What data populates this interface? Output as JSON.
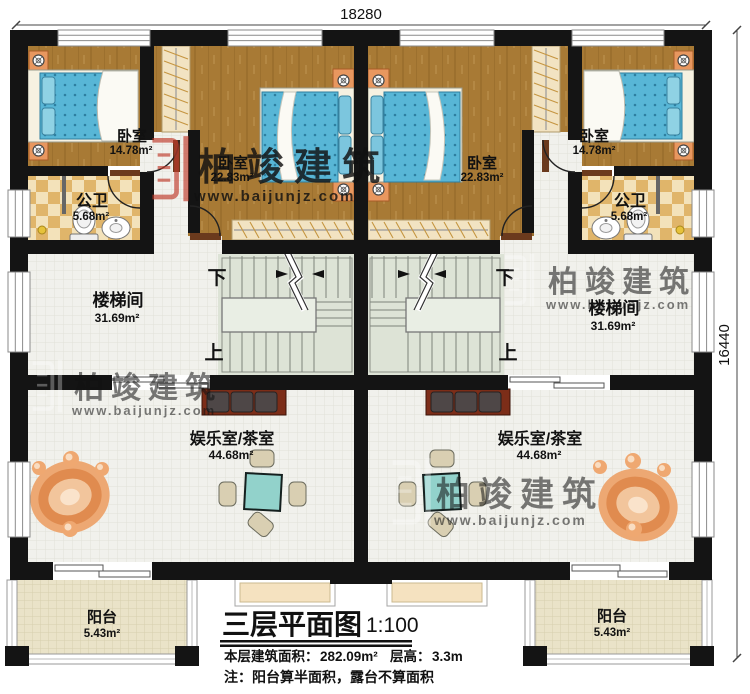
{
  "dimensions": {
    "top": "18280",
    "right": "16440"
  },
  "stairs": {
    "down": "下",
    "up": "上"
  },
  "watermark": {
    "brand": "柏竣建筑",
    "url": "www.baijunjz.com"
  },
  "rooms": {
    "bedroom_small_left": {
      "name": "卧室",
      "area": "14.78m²"
    },
    "bedroom_large_left": {
      "name": "卧室",
      "area": "22.83m²"
    },
    "bathroom_left": {
      "name": "公卫",
      "area": "5.68m²"
    },
    "stairwell_left": {
      "name": "楼梯间",
      "area": "31.69m²"
    },
    "recreation_left": {
      "name": "娱乐室/茶室",
      "area": "44.68m²"
    },
    "balcony_left": {
      "name": "阳台",
      "area": "5.43m²"
    },
    "bedroom_small_right": {
      "name": "卧室",
      "area": "14.78m²"
    },
    "bedroom_large_right": {
      "name": "卧室",
      "area": "22.83m²"
    },
    "bathroom_right": {
      "name": "公卫",
      "area": "5.68m²"
    },
    "stairwell_right": {
      "name": "楼梯间",
      "area": "31.69m²"
    },
    "recreation_right": {
      "name": "娱乐室/茶室",
      "area": "44.68m²"
    },
    "balcony_right": {
      "name": "阳台",
      "area": "5.43m²"
    }
  },
  "title_block": {
    "title": "三层平面图",
    "scale": "1:100",
    "area_label": "本层建筑面积：",
    "area_value": "282.09m²",
    "floor_height_label": "层高：",
    "floor_height_value": "3.3m",
    "note": "注：阳台算半面积，露台不算面积"
  },
  "colors": {
    "wall": "#141414",
    "wood_floor": "#a87a35",
    "bed_blue": "#58b6d6",
    "watermark_red": "#c03a2a"
  }
}
